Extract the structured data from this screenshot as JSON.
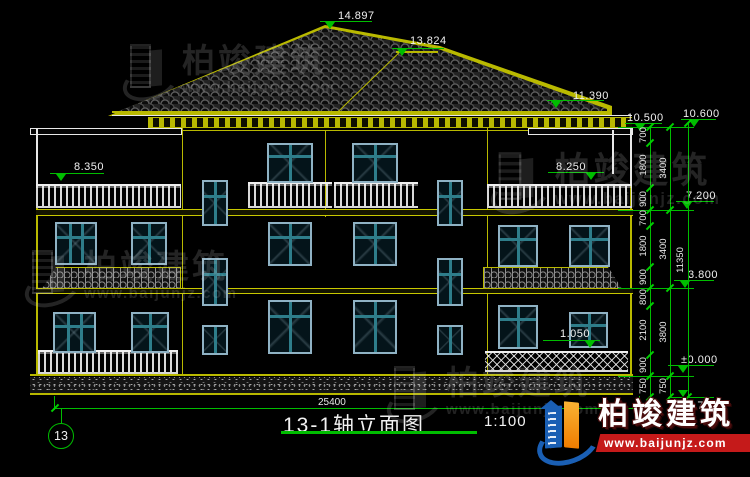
{
  "drawing": {
    "title": "13-1轴立面图",
    "scale": "1:100",
    "grid_bubble": "13"
  },
  "dims": {
    "total_width": "25400",
    "total_height": "11350",
    "chain_detail": [
      "700",
      "1800",
      "900",
      "700",
      "1800",
      "900",
      "800",
      "2100",
      "900",
      "750"
    ],
    "chain_floors": [
      "3400",
      "3400",
      "3800",
      "750"
    ]
  },
  "elevations": {
    "ridge_main": "14.897",
    "ridge_secondary": "13.824",
    "eave": "11.390",
    "parapet_inner": "10.500",
    "parapet_outer": "10.600",
    "terrace_left": "8.350",
    "terrace_right": "8.250",
    "floor3": "7.200",
    "floor2": "3.800",
    "window_sill": "1.050",
    "ground_zero": "±0.000",
    "site_ground": "-0.750"
  },
  "brand": {
    "name": "柏竣建筑",
    "url": "www.baijunjz.com"
  },
  "colors": {
    "background": "#000000",
    "dimension_green": "#00bd00",
    "wall_yellow": "#b9b900",
    "line_white": "#e8e8e8",
    "window_frame_blue": "#8fb2c4",
    "window_mullion_teal": "#2e7d8a",
    "logo_blue": "#1a5fb4",
    "logo_orange": "#f7941d",
    "banner_red": "#c51a1a"
  }
}
